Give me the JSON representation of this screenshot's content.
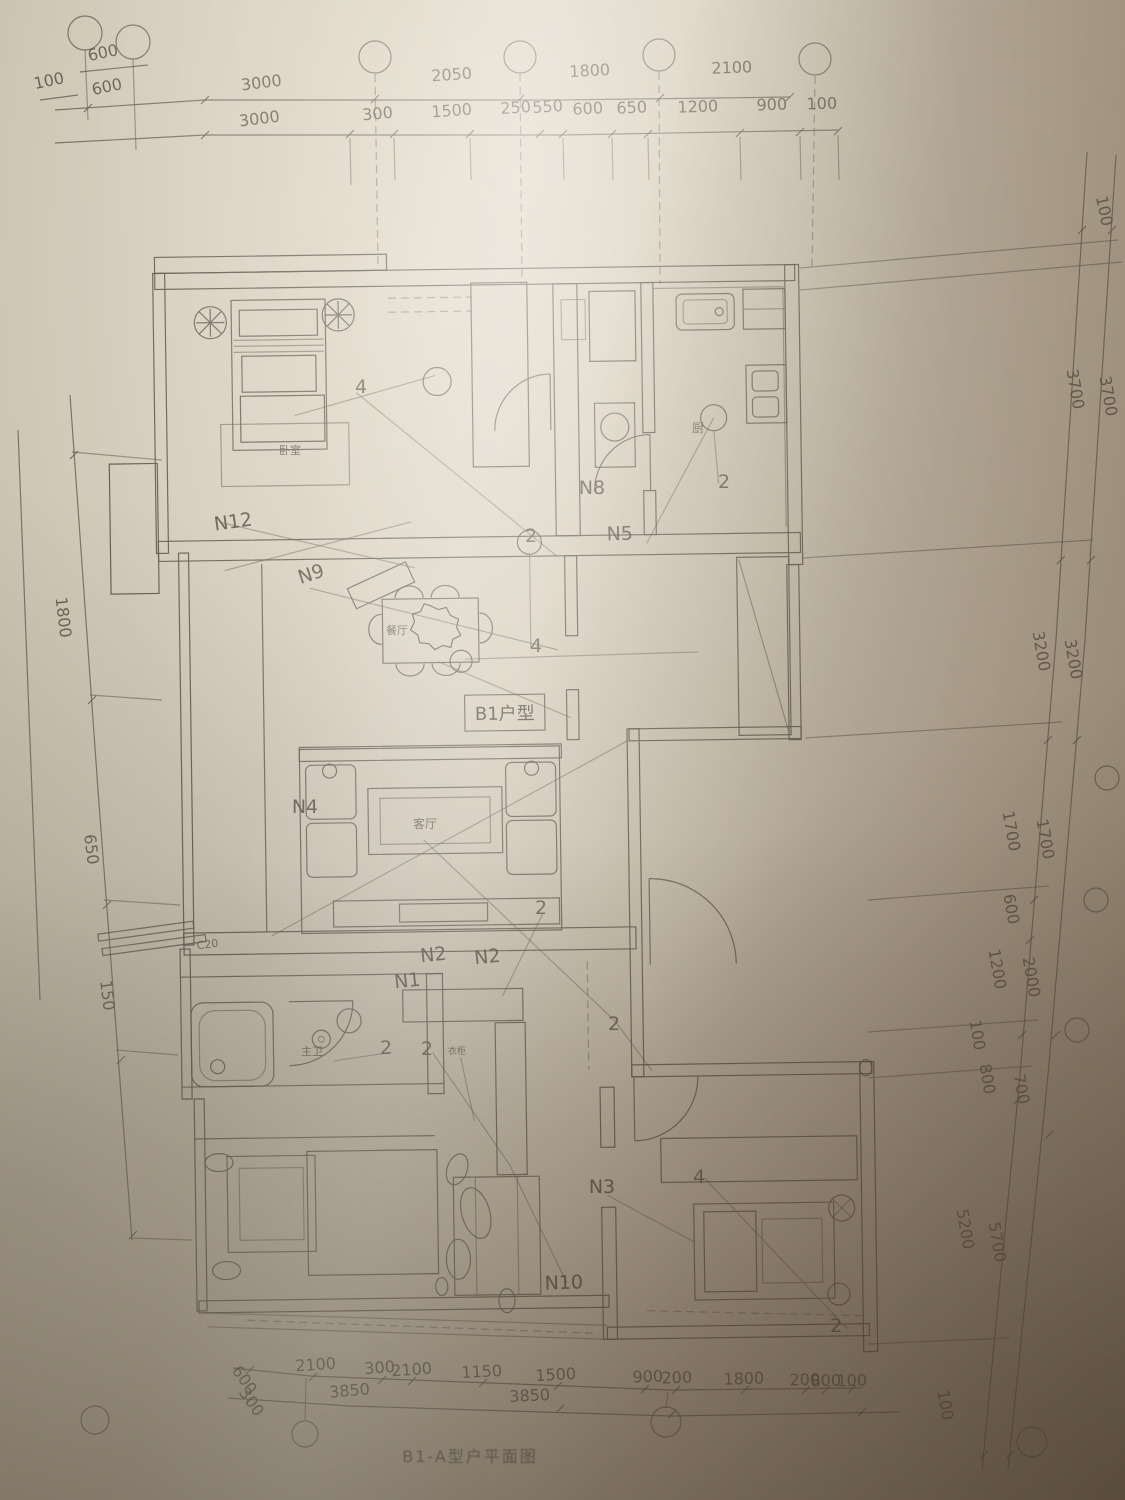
{
  "caption": {
    "text": "B1-A型户平面图"
  },
  "plan": {
    "unit_box_label": "B1户型"
  },
  "colors": {
    "paper_light": "#ded6c8",
    "paper_mid": "#c3b8a5",
    "paper_dark": "#a3967f",
    "ink": "#5d564c",
    "smudge": "#332a1f"
  },
  "labels": {
    "dims_top": [
      {
        "t": "600",
        "x": 104,
        "y": 58,
        "r": -12
      },
      {
        "t": "100",
        "x": 50,
        "y": 86,
        "r": -12
      },
      {
        "t": "600",
        "x": 108,
        "y": 92,
        "r": -12
      },
      {
        "t": "3000",
        "x": 262,
        "y": 88,
        "r": -7
      },
      {
        "t": "2050",
        "x": 452,
        "y": 80,
        "r": -4
      },
      {
        "t": "1800",
        "x": 590,
        "y": 76,
        "r": -3
      },
      {
        "t": "2100",
        "x": 732,
        "y": 73,
        "r": -2
      },
      {
        "t": "3000",
        "x": 260,
        "y": 124,
        "r": -7
      },
      {
        "t": "300",
        "x": 378,
        "y": 119,
        "r": -5
      },
      {
        "t": "1500",
        "x": 452,
        "y": 116,
        "r": -4
      },
      {
        "t": "250",
        "x": 516,
        "y": 113,
        "r": -4
      },
      {
        "t": "550",
        "x": 548,
        "y": 112,
        "r": -4
      },
      {
        "t": "600",
        "x": 588,
        "y": 114,
        "r": -3
      },
      {
        "t": "650",
        "x": 632,
        "y": 113,
        "r": -3
      },
      {
        "t": "1200",
        "x": 698,
        "y": 112,
        "r": -2
      },
      {
        "t": "900",
        "x": 772,
        "y": 110,
        "r": -2
      },
      {
        "t": "100",
        "x": 822,
        "y": 109,
        "r": -2
      }
    ],
    "dims_right": [
      {
        "t": "100",
        "x": 1099,
        "y": 212,
        "r": 78
      },
      {
        "t": "3700",
        "x": 1070,
        "y": 390,
        "r": 80
      },
      {
        "t": "3700",
        "x": 1103,
        "y": 397,
        "r": 80
      },
      {
        "t": "3200",
        "x": 1036,
        "y": 652,
        "r": 80
      },
      {
        "t": "3200",
        "x": 1068,
        "y": 660,
        "r": 80
      },
      {
        "t": "1700",
        "x": 1006,
        "y": 832,
        "r": 80
      },
      {
        "t": "1700",
        "x": 1040,
        "y": 840,
        "r": 80
      },
      {
        "t": "600",
        "x": 1006,
        "y": 910,
        "r": 80
      },
      {
        "t": "1200",
        "x": 992,
        "y": 970,
        "r": 80
      },
      {
        "t": "2000",
        "x": 1026,
        "y": 978,
        "r": 80
      },
      {
        "t": "100",
        "x": 972,
        "y": 1036,
        "r": 80
      },
      {
        "t": "800",
        "x": 982,
        "y": 1080,
        "r": 80
      },
      {
        "t": "700",
        "x": 1016,
        "y": 1090,
        "r": 80
      },
      {
        "t": "5200",
        "x": 960,
        "y": 1230,
        "r": 80
      },
      {
        "t": "5700",
        "x": 992,
        "y": 1243,
        "r": 80
      },
      {
        "t": "100",
        "x": 940,
        "y": 1406,
        "r": 80
      }
    ],
    "dims_left": [
      {
        "t": "1800",
        "x": 58,
        "y": 618,
        "r": 83
      },
      {
        "t": "650",
        "x": 86,
        "y": 850,
        "r": 83
      },
      {
        "t": "150",
        "x": 102,
        "y": 996,
        "r": 83
      }
    ],
    "dims_bottom": [
      {
        "t": "600",
        "x": 240,
        "y": 1383,
        "r": 55
      },
      {
        "t": "300",
        "x": 247,
        "y": 1405,
        "r": 55
      },
      {
        "t": "2100",
        "x": 316,
        "y": 1370,
        "r": -4
      },
      {
        "t": "300",
        "x": 380,
        "y": 1373,
        "r": -4
      },
      {
        "t": "2100",
        "x": 412,
        "y": 1375,
        "r": -4
      },
      {
        "t": "1150",
        "x": 482,
        "y": 1377,
        "r": -3
      },
      {
        "t": "1500",
        "x": 556,
        "y": 1380,
        "r": -3
      },
      {
        "t": "900",
        "x": 648,
        "y": 1382,
        "r": -2
      },
      {
        "t": "200",
        "x": 677,
        "y": 1383,
        "r": -2
      },
      {
        "t": "1800",
        "x": 744,
        "y": 1384,
        "r": -2
      },
      {
        "t": "200",
        "x": 805,
        "y": 1385,
        "r": -2
      },
      {
        "t": "800",
        "x": 826,
        "y": 1386,
        "r": -2
      },
      {
        "t": "100",
        "x": 852,
        "y": 1386,
        "r": -2
      },
      {
        "t": "3850",
        "x": 350,
        "y": 1396,
        "r": -5
      },
      {
        "t": "3850",
        "x": 530,
        "y": 1401,
        "r": -3
      }
    ],
    "circuits": [
      {
        "t": "N12",
        "x": 234,
        "y": 528,
        "r": -8
      },
      {
        "t": "N9",
        "x": 313,
        "y": 580,
        "r": -18
      },
      {
        "t": "N8",
        "x": 592,
        "y": 494,
        "r": 0
      },
      {
        "t": "N5",
        "x": 620,
        "y": 540,
        "r": -2
      },
      {
        "t": "N4",
        "x": 305,
        "y": 813,
        "r": 0
      },
      {
        "t": "N2",
        "x": 434,
        "y": 961,
        "r": -6
      },
      {
        "t": "N2",
        "x": 488,
        "y": 963,
        "r": -6
      },
      {
        "t": "N1",
        "x": 408,
        "y": 987,
        "r": -6
      },
      {
        "t": "N3",
        "x": 602,
        "y": 1193,
        "r": 0
      },
      {
        "t": "N10",
        "x": 564,
        "y": 1289,
        "r": -2
      }
    ],
    "rooms": [
      {
        "t": "餐厅",
        "x": 397,
        "y": 634,
        "s": 11
      },
      {
        "t": "客厅",
        "x": 425,
        "y": 828,
        "s": 12
      },
      {
        "t": "主卫",
        "x": 312,
        "y": 1055,
        "s": 11
      },
      {
        "t": "厨",
        "x": 698,
        "y": 432,
        "s": 12
      },
      {
        "t": "卧室",
        "x": 290,
        "y": 454,
        "s": 11
      },
      {
        "t": "衣柜",
        "x": 457,
        "y": 1054,
        "s": 9
      }
    ],
    "numbers": [
      {
        "t": "4",
        "x": 361,
        "y": 393
      },
      {
        "t": "2",
        "x": 724,
        "y": 488
      },
      {
        "t": "2",
        "x": 531,
        "y": 542
      },
      {
        "t": "4",
        "x": 536,
        "y": 652
      },
      {
        "t": "2",
        "x": 541,
        "y": 914
      },
      {
        "t": "2",
        "x": 386,
        "y": 1054
      },
      {
        "t": "2",
        "x": 427,
        "y": 1055
      },
      {
        "t": "2",
        "x": 614,
        "y": 1030
      },
      {
        "t": "4",
        "x": 699,
        "y": 1183
      },
      {
        "t": "2",
        "x": 836,
        "y": 1332
      }
    ],
    "annotations": [
      {
        "t": "C20",
        "x": 208,
        "y": 948,
        "r": -7,
        "s": 11
      }
    ]
  }
}
